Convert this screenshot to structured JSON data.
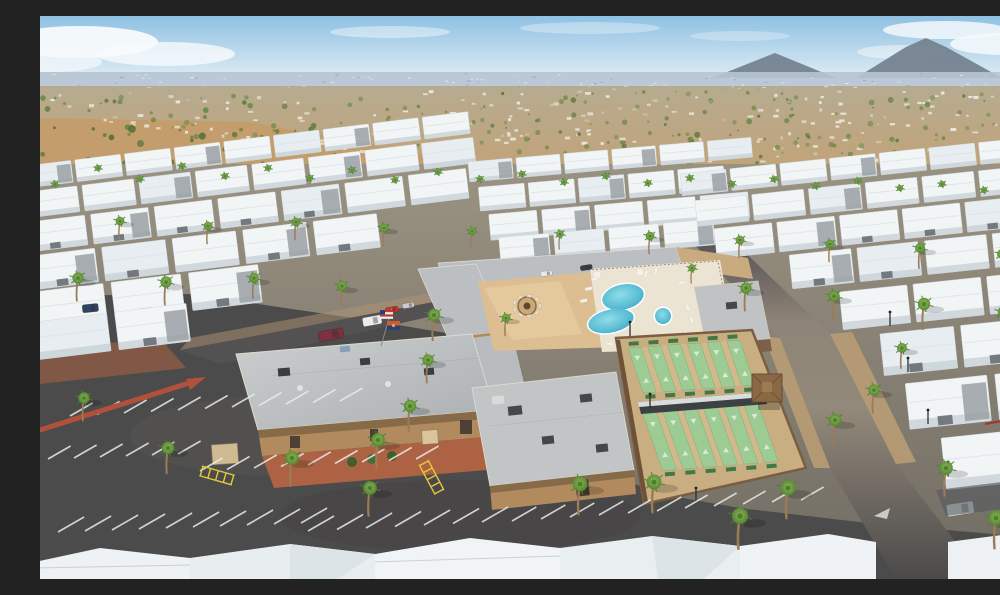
{
  "meta": {
    "description": "Aerial drone photo of a desert mobile-home resort community: rows of white-roofed homes with palm trees, central clubhouse complex with swimming pool, spa, fire-pit courtyard, shuffleboard courts, large asphalt parking lot, desert suburb and mountains on the horizon under a light blue sky."
  },
  "palette": {
    "sky_top": "#8fc1e3",
    "sky_low": "#d8e9f3",
    "cloud": "#f7fafc",
    "mountain": "#717d8c",
    "horizon_band": "#b7c4d3",
    "suburb_hi": "#b6ab90",
    "suburb_lo": "#c1a379",
    "desert": "#c49d6d",
    "shrub": "#5d7a3e",
    "tree_green": "#6a8a44",
    "park_base": "#968e7e",
    "asphalt": "#4c4b4b",
    "road_tan": "#93897a",
    "gravel": "#b89c74",
    "roof_white": "#f2f5f6",
    "roof_shade": "#c6cfd5",
    "roof_gray": "#bcbfc1",
    "wall_tan": "#b18a5e",
    "wall_dark": "#6b5340",
    "paver": "#ddbe93",
    "deck": "#ece4d3",
    "pool_hi": "#8fdde8",
    "pool_lo": "#39a9c9",
    "court_green": "#9ccb93",
    "court_tan": "#c9ae81",
    "bench_green": "#3f7a46",
    "red_curb": "#b2503c",
    "red_paver": "#ad6243",
    "yellow": "#e6c83d",
    "palm_hi": "#8cbb4d",
    "palm_lo": "#4e8032",
    "trunk": "#9b7b58",
    "line_white": "#e9ebeb",
    "awning_tan": "#c9ab7f",
    "flag_red": "#c0392b",
    "flag_blue": "#2b3f75"
  },
  "scene": {
    "clouds": [
      {
        "x": 40,
        "y": 26,
        "rx": 78,
        "ry": 16,
        "o": 0.95
      },
      {
        "x": 125,
        "y": 38,
        "rx": 70,
        "ry": 12,
        "o": 0.8
      },
      {
        "x": 10,
        "y": 46,
        "rx": 52,
        "ry": 10,
        "o": 0.7
      },
      {
        "x": 350,
        "y": 16,
        "rx": 60,
        "ry": 6,
        "o": 0.45
      },
      {
        "x": 550,
        "y": 12,
        "rx": 70,
        "ry": 6,
        "o": 0.35
      },
      {
        "x": 700,
        "y": 20,
        "rx": 50,
        "ry": 5,
        "o": 0.3
      },
      {
        "x": 905,
        "y": 14,
        "rx": 62,
        "ry": 9,
        "o": 0.8
      },
      {
        "x": 965,
        "y": 28,
        "rx": 55,
        "ry": 11,
        "o": 0.85
      },
      {
        "x": 862,
        "y": 36,
        "rx": 45,
        "ry": 7,
        "o": 0.5
      }
    ],
    "mountains": [
      {
        "pts": "672,62 735,37 796,62"
      },
      {
        "pts": "816,62 866,31 886,22 906,31 962,62"
      }
    ],
    "speckles": {
      "houses": 230,
      "trees": 250,
      "horizon": 90,
      "shrubs": 50
    },
    "homes": {
      "blocks": [
        {
          "rot": -7,
          "rows": [
            {
              "x": -15,
              "y": 150,
              "w": 46,
              "h": 22,
              "gap": 4,
              "n": 9
            },
            {
              "x": -18,
              "y": 176,
              "w": 52,
              "h": 26,
              "gap": 5,
              "n": 8
            },
            {
              "x": -20,
              "y": 206,
              "w": 58,
              "h": 30,
              "gap": 6,
              "n": 7
            },
            {
              "x": -20,
              "y": 240,
              "w": 64,
              "h": 34,
              "gap": 7,
              "n": 5
            },
            {
              "x": -22,
              "y": 276,
              "w": 70,
              "h": 38,
              "gap": 8,
              "n": 3
            },
            {
              "x": -24,
              "y": 306,
              "w": 72,
              "h": 38,
              "gap": 8,
              "n": 2
            }
          ]
        },
        {
          "rot": -5,
          "rows": [
            {
              "x": 428,
              "y": 146,
              "w": 44,
              "h": 20,
              "gap": 4,
              "n": 6
            },
            {
              "x": 436,
              "y": 172,
              "w": 46,
              "h": 24,
              "gap": 4,
              "n": 5
            },
            {
              "x": 444,
              "y": 200,
              "w": 48,
              "h": 26,
              "gap": 5,
              "n": 5
            },
            {
              "x": 452,
              "y": 224,
              "w": 50,
              "h": 26,
              "gap": 5,
              "n": 4
            }
          ]
        },
        {
          "rot": -6,
          "rows": [
            {
              "x": 640,
              "y": 158,
              "w": 46,
              "h": 22,
              "gap": 4,
              "n": 8
            },
            {
              "x": 652,
              "y": 186,
              "w": 52,
              "h": 26,
              "gap": 5,
              "n": 7
            },
            {
              "x": 668,
              "y": 216,
              "w": 58,
              "h": 30,
              "gap": 5,
              "n": 6
            },
            {
              "x": 740,
              "y": 250,
              "w": 62,
              "h": 34,
              "gap": 6,
              "n": 5
            },
            {
              "x": 786,
              "y": 292,
              "w": 68,
              "h": 38,
              "gap": 6,
              "n": 4
            },
            {
              "x": 822,
              "y": 338,
              "w": 74,
              "h": 42,
              "gap": 7,
              "n": 3
            },
            {
              "x": 842,
              "y": 390,
              "w": 82,
              "h": 46,
              "gap": 8,
              "n": 2
            },
            {
              "x": 872,
              "y": 448,
              "w": 90,
              "h": 52,
              "gap": 8,
              "n": 2
            }
          ]
        }
      ]
    },
    "palms": [
      [
        15,
        168,
        5
      ],
      [
        58,
        152,
        5
      ],
      [
        100,
        163,
        5
      ],
      [
        142,
        150,
        5
      ],
      [
        185,
        160,
        5
      ],
      [
        228,
        152,
        5
      ],
      [
        270,
        162,
        5
      ],
      [
        312,
        154,
        5
      ],
      [
        355,
        164,
        5
      ],
      [
        398,
        156,
        5
      ],
      [
        440,
        163,
        5
      ],
      [
        482,
        158,
        5
      ],
      [
        524,
        166,
        5
      ],
      [
        566,
        160,
        5
      ],
      [
        608,
        167,
        5
      ],
      [
        650,
        162,
        5
      ],
      [
        692,
        168,
        5
      ],
      [
        734,
        163,
        5
      ],
      [
        776,
        170,
        5
      ],
      [
        818,
        165,
        5
      ],
      [
        860,
        172,
        5
      ],
      [
        902,
        168,
        5
      ],
      [
        944,
        174,
        5
      ],
      [
        986,
        170,
        5
      ],
      [
        80,
        205,
        7
      ],
      [
        168,
        210,
        7
      ],
      [
        256,
        206,
        7
      ],
      [
        344,
        212,
        7
      ],
      [
        432,
        215,
        6
      ],
      [
        520,
        218,
        6
      ],
      [
        610,
        220,
        7
      ],
      [
        700,
        224,
        7
      ],
      [
        790,
        228,
        7
      ],
      [
        880,
        232,
        8
      ],
      [
        962,
        238,
        8
      ],
      [
        38,
        262,
        9
      ],
      [
        126,
        266,
        9
      ],
      [
        214,
        262,
        8
      ],
      [
        302,
        270,
        8
      ],
      [
        706,
        272,
        9
      ],
      [
        794,
        280,
        9
      ],
      [
        884,
        288,
        10
      ],
      [
        964,
        296,
        10
      ],
      [
        394,
        299,
        10
      ],
      [
        388,
        344,
        9
      ],
      [
        370,
        390,
        10
      ],
      [
        338,
        424,
        11
      ],
      [
        252,
        442,
        11
      ],
      [
        128,
        432,
        10
      ],
      [
        44,
        382,
        9
      ],
      [
        540,
        468,
        12
      ],
      [
        614,
        466,
        12
      ],
      [
        330,
        472,
        11
      ],
      [
        700,
        500,
        13
      ],
      [
        748,
        472,
        12
      ],
      [
        795,
        404,
        10
      ],
      [
        834,
        374,
        9
      ],
      [
        862,
        332,
        8
      ],
      [
        906,
        452,
        11
      ],
      [
        956,
        502,
        12
      ],
      [
        984,
        424,
        10
      ],
      [
        652,
        252,
        6
      ],
      [
        466,
        302,
        7
      ]
    ],
    "parking_groups": [
      {
        "x": 30,
        "y": 400,
        "n": 11,
        "dx": 27,
        "dy": -1.5,
        "len": 26
      },
      {
        "x": 8,
        "y": 443,
        "n": 6,
        "dx": 26,
        "dy": -1,
        "len": 26
      },
      {
        "x": 160,
        "y": 455,
        "n": 9,
        "dx": 27,
        "dy": -1.5,
        "len": 26
      },
      {
        "x": 18,
        "y": 516,
        "n": 10,
        "dx": 27,
        "dy": -1,
        "len": 30
      },
      {
        "x": 268,
        "y": 515,
        "n": 7,
        "dx": 29,
        "dy": -1.5,
        "len": 30
      },
      {
        "x": 472,
        "y": 505,
        "n": 6,
        "dx": 29,
        "dy": -2,
        "len": 28
      },
      {
        "x": 645,
        "y": 492,
        "n": 5,
        "dx": 29,
        "dy": -2,
        "len": 26
      }
    ],
    "cars": [
      {
        "x": 278,
        "y": 316,
        "w": 25,
        "h": 10,
        "rot": -10,
        "c": "#7e3040"
      },
      {
        "x": 322,
        "y": 302,
        "w": 19,
        "h": 9,
        "rot": -10,
        "c": "#e9ecee"
      },
      {
        "x": 345,
        "y": 292,
        "w": 13,
        "h": 6,
        "rot": -10,
        "c": "#c0392b"
      },
      {
        "x": 362,
        "y": 288,
        "w": 12,
        "h": 5,
        "rot": -10,
        "c": "#c8cccd"
      },
      {
        "x": 500,
        "y": 256,
        "w": 12,
        "h": 5,
        "rot": -9,
        "c": "#e8e8e8"
      },
      {
        "x": 540,
        "y": 250,
        "w": 12,
        "h": 5,
        "rot": -9,
        "c": "#3a3d40"
      },
      {
        "x": 42,
        "y": 289,
        "w": 16,
        "h": 8,
        "rot": -6,
        "c": "#2e4461"
      },
      {
        "x": 906,
        "y": 489,
        "w": 27,
        "h": 12,
        "rot": -9,
        "c": "#eceff1"
      }
    ],
    "loungers": [
      [
        551,
        262,
        -12
      ],
      [
        545,
        272,
        -12
      ],
      [
        540,
        284,
        -12
      ],
      [
        604,
        261,
        -80
      ],
      [
        614,
        258,
        -80
      ],
      [
        638,
        266,
        -12
      ],
      [
        648,
        288,
        70
      ],
      [
        652,
        300,
        70
      ],
      [
        644,
        314,
        20
      ],
      [
        600,
        322,
        5
      ],
      [
        586,
        321,
        5
      ],
      [
        566,
        326,
        5
      ]
    ],
    "firepit": {
      "cx": 487,
      "cy": 290,
      "chairs": 9,
      "r": 13
    },
    "colonnade": {
      "x": 414,
      "y": 270,
      "n": 14,
      "dx": 16.4,
      "dy": -1.05,
      "w": 2.6,
      "h": 8
    },
    "courts": {
      "banks": [
        {
          "tx": 588,
          "ty": 332,
          "rot": -4,
          "lanes": 6,
          "lw": 13,
          "gap": 6.8,
          "h": 46,
          "sk": 12
        },
        {
          "tx": 602,
          "ty": 396,
          "rot": -4.5,
          "lanes": 6,
          "lw": 14,
          "gap": 6.4,
          "h": 60,
          "sk": 16
        }
      ]
    },
    "light_posts": [
      [
        850,
        310
      ],
      [
        868,
        356
      ],
      [
        888,
        408
      ],
      [
        908,
        460
      ],
      [
        590,
        320
      ],
      [
        610,
        392
      ],
      [
        656,
        486
      ]
    ],
    "ladders": [
      {
        "x": 162,
        "y": 450,
        "rot": 16
      },
      {
        "x": 388,
        "y": 444,
        "rot": 62
      }
    ]
  }
}
